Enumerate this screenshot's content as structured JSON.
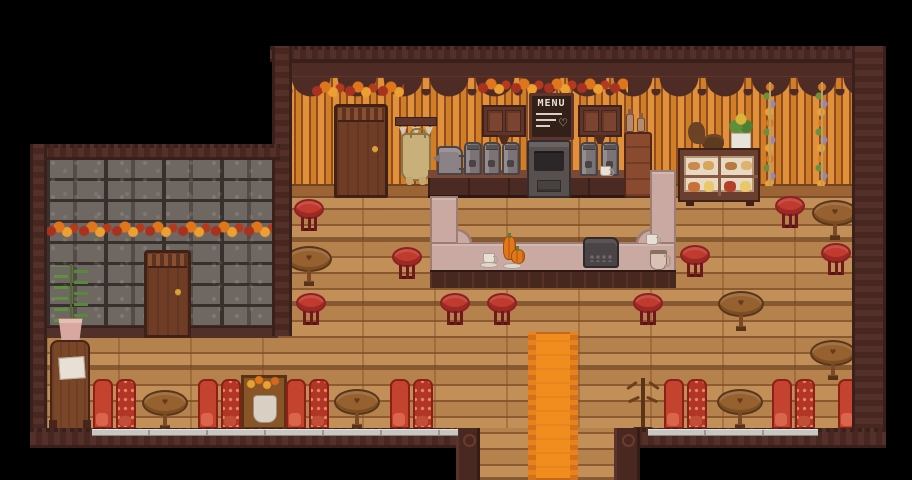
{
  "scene": {
    "title": "Cozy pixel cafe interior",
    "description": "Top-down pixel-art coffee shop with autumn decorations, bar counter, stools and booths"
  },
  "menu_board": {
    "title": "MENU",
    "heart_icon": "♡"
  },
  "icons": {
    "heart": "♥"
  },
  "palette": {
    "background": "#000000",
    "frame": "#4a2822",
    "frame_light": "#5d352c",
    "wall_orange_light": "#e2913a",
    "wall_orange_dark": "#d17e26",
    "wall_stripe_line": "#8c4d22",
    "cornice": "#4f2b26",
    "stone_fill": "#6f6762",
    "stone_gap": "#38302c",
    "floor_wood": "#bf8951",
    "counter_top": "#c9a9a1",
    "counter_edge": "#9e7d75",
    "counter_front": "#46281f",
    "stool_red": "#c13a2e",
    "stool_rim": "#8c2023",
    "booth_red": "#c4432f",
    "booth_dark": "#8c2018",
    "table_wood": "#96602f",
    "table_edge": "#5a3619",
    "rug_orange": "#f08d1e",
    "rug_border": "#d2701c",
    "leaf_red": "#a8321f",
    "leaf_orange": "#e0761c",
    "leaf_yellow": "#eda032",
    "door_wood": "#6f3d26",
    "apron_tan": "#c9b07a",
    "paper_white": "#e8e0d4",
    "strip_silver": "#c9c5c1"
  }
}
